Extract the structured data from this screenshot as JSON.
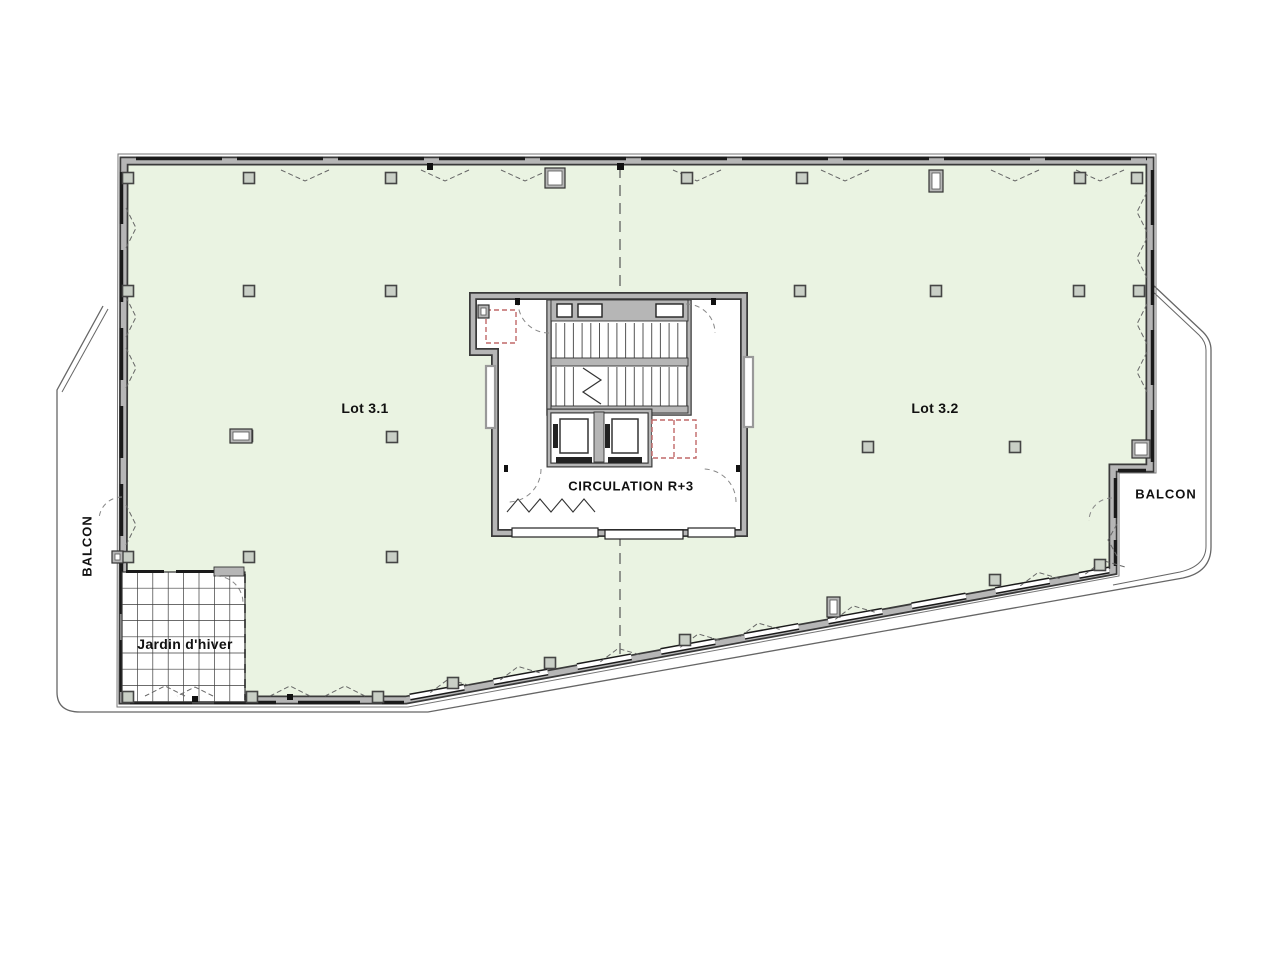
{
  "floorplan": {
    "labels": {
      "lot1": "Lot 3.1",
      "lot2": "Lot 3.2",
      "circulation": "CIRCULATION R+3",
      "balcony_left": "BALCON",
      "balcony_right": "BALCON",
      "winter_garden": "Jardin d'hiver"
    },
    "colors": {
      "floor_fill": "#eaf3e2",
      "wall_gray": "#b6b6b6",
      "wall_outline": "#3a3a3a",
      "window_black": "#1a1a1a",
      "riser_red": "#c06868",
      "dashed_line": "#555555",
      "boundary_line": "#666666",
      "column_fill": "#c9cfc6",
      "column_border": "#454545",
      "grid_line": "#3c3c3c",
      "arc_dash": "#888888"
    },
    "columns": [
      [
        128,
        178
      ],
      [
        249,
        178
      ],
      [
        391,
        178
      ],
      [
        687,
        178
      ],
      [
        802,
        178
      ],
      [
        1080,
        178
      ],
      [
        1137,
        178
      ],
      [
        128,
        291
      ],
      [
        249,
        291
      ],
      [
        391,
        291
      ],
      [
        800,
        291
      ],
      [
        936,
        291
      ],
      [
        1079,
        291
      ],
      [
        1139,
        291
      ],
      [
        247,
        436
      ],
      [
        392,
        437
      ],
      [
        868,
        447
      ],
      [
        1015,
        447
      ],
      [
        128,
        557
      ],
      [
        249,
        557
      ],
      [
        392,
        557
      ],
      [
        128,
        697
      ],
      [
        252,
        697
      ],
      [
        378,
        697
      ],
      [
        453,
        683
      ],
      [
        550,
        663
      ],
      [
        685,
        640
      ],
      [
        995,
        580
      ],
      [
        1100,
        565
      ]
    ],
    "fixtures": [
      {
        "x": 545,
        "y": 168,
        "w": 20,
        "h": 20
      },
      {
        "x": 929,
        "y": 170,
        "w": 14,
        "h": 22
      },
      {
        "x": 230,
        "y": 429,
        "w": 22,
        "h": 14
      },
      {
        "x": 1132,
        "y": 440,
        "w": 18,
        "h": 18
      },
      {
        "x": 827,
        "y": 597,
        "w": 13,
        "h": 20
      },
      {
        "x": 112,
        "y": 551,
        "w": 11,
        "h": 12
      },
      {
        "x": 478,
        "y": 305,
        "w": 11,
        "h": 13
      }
    ]
  }
}
